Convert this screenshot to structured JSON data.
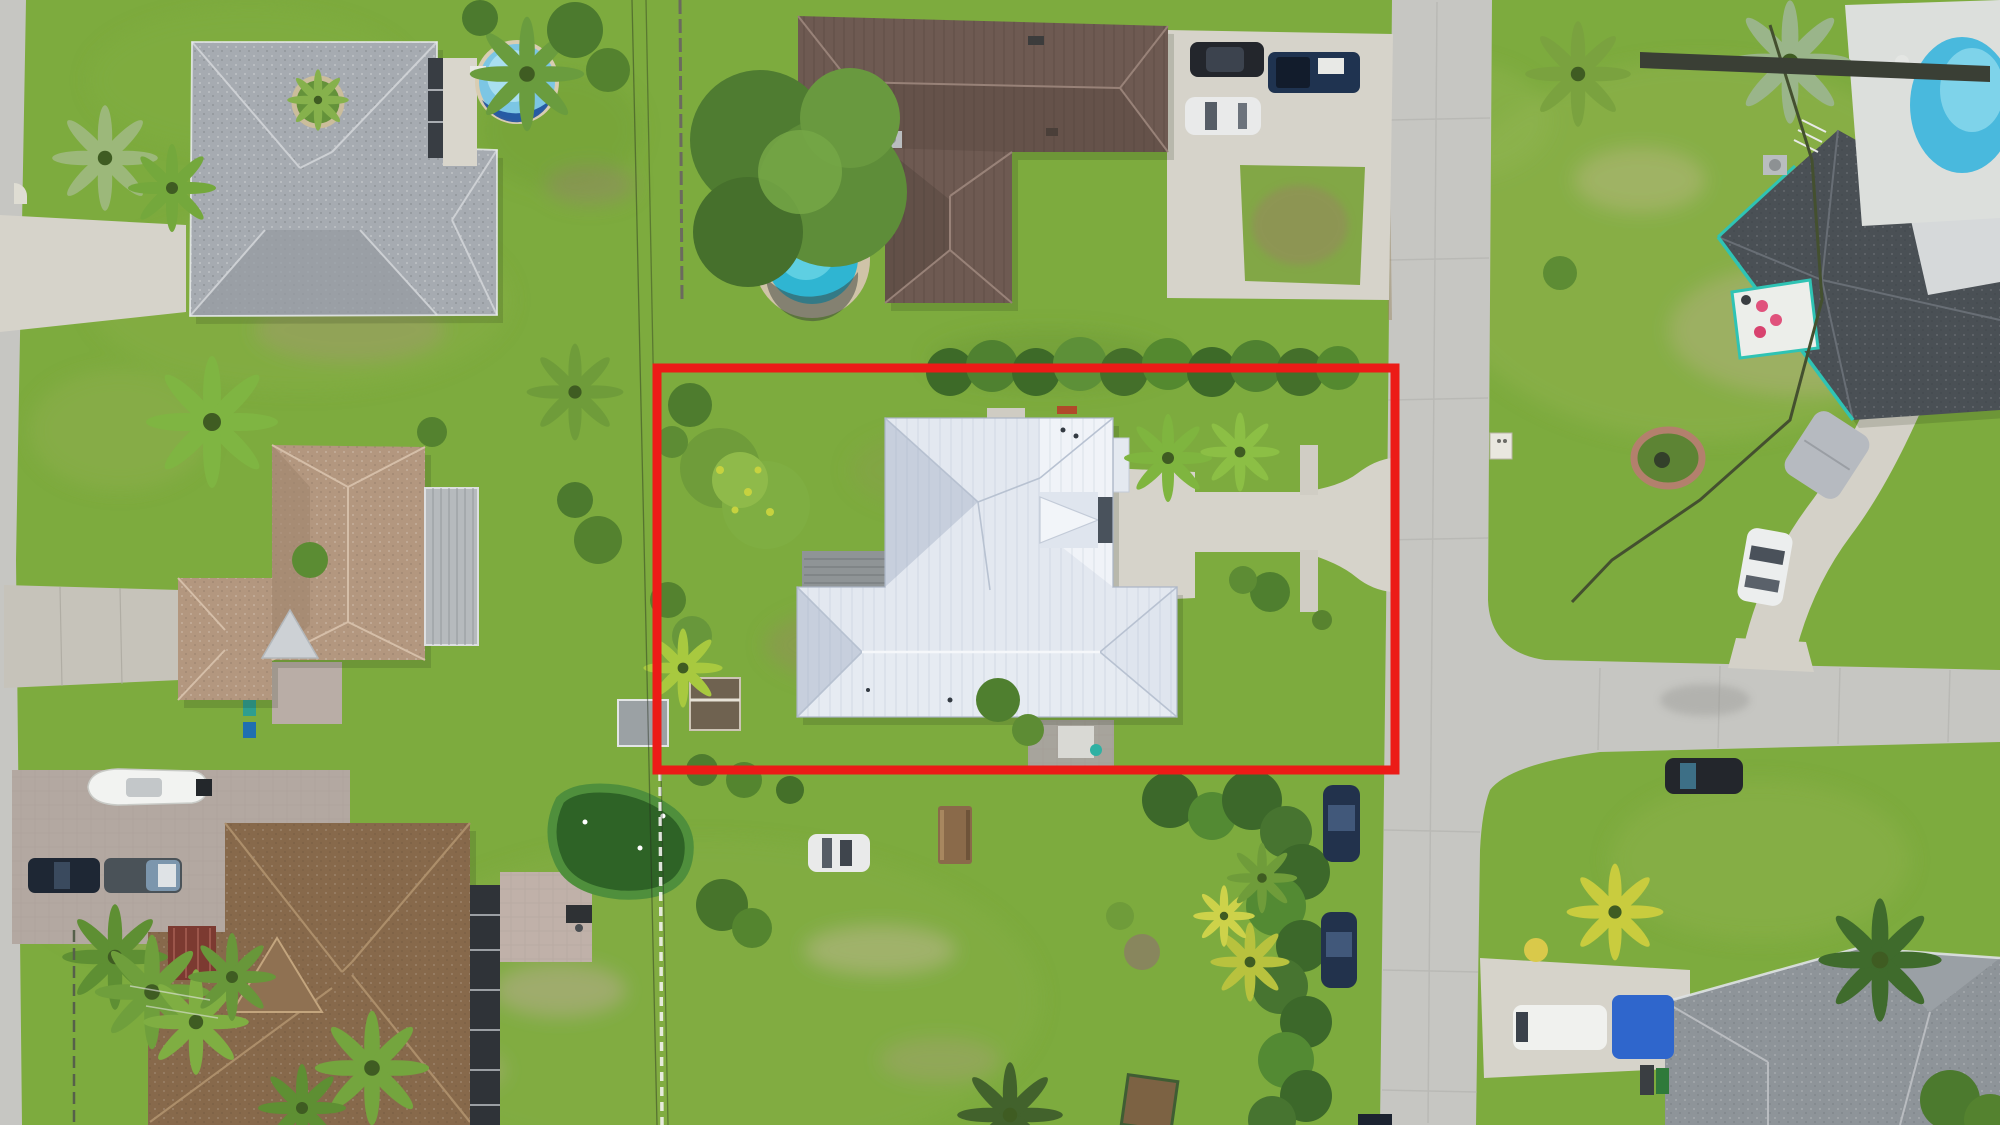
{
  "meta": {
    "title": "Aerial drone photo of suburban neighborhood with outlined property lot",
    "view": "top-down",
    "width_px": 2000,
    "height_px": 1125
  },
  "annotation": {
    "name": "property-boundary",
    "shape": "rectangle",
    "purpose": "highlights the listed lot (white metal-roof house with driveway to street)"
  },
  "colors": {
    "grass": "#7dab3e",
    "grass_light": "#8db34a",
    "road": "#c6c6c2",
    "concrete": "#d6d3ca",
    "concrete_old": "#c6c3ba",
    "paver": "#b3a8a1",
    "boundary": "#ec1b17",
    "roof_subject": "#e3e8f0",
    "roof_subject_shade": "#c7cfdd",
    "roof_brown": "#6e5a52",
    "roof_gray": "#a6abb1",
    "roof_tan": "#b3977f",
    "roof_brown_bl": "#87694b",
    "roof_gray_br": "#8e9499",
    "roof_dark_tr": "#4a5055",
    "teal_trim": "#2fc3b4",
    "pool_round": "#7cc6e4",
    "pool_ring": "#1d4f9c",
    "pool_small": "#2fb5d2",
    "pool_kidney": "#49b9dd",
    "pool_deck": "#dcdfdc",
    "putting_green": "#2e6326",
    "putting_fringe": "#4f8f3c",
    "hedge": "#3f6d28",
    "tree": "#5e8d39",
    "palm": "#7fb542",
    "deck_wood": "#8f9496",
    "lanai": "#2f3338",
    "tarp_blue": "#2f66cc",
    "mulch_red": "#8a4a2e",
    "boat_white": "#f2f3f1",
    "vehicle_dark": "#23262c",
    "vehicle_navy": "#1f3350",
    "vehicle_white": "#e9eaea"
  },
  "objects": [
    {
      "name": "subject-house",
      "desc": "white standing-seam metal hip roof house inside red boundary"
    },
    {
      "name": "subject-driveway",
      "desc": "concrete drive flaring to street on east side"
    },
    {
      "name": "north-south-road",
      "desc": "concrete street along east side of lot"
    },
    {
      "name": "east-branch-road",
      "desc": "side street joining at T-intersection"
    },
    {
      "name": "west-road",
      "desc": "street strip at far left edge"
    },
    {
      "name": "house-top-left",
      "desc": "gray shingle roof home with above-ground pool"
    },
    {
      "name": "house-top-center",
      "desc": "brown metal roof home with small round pool and parking pad"
    },
    {
      "name": "house-top-right",
      "desc": "dark roof home with teal trim, kidney pool, curved driveway"
    },
    {
      "name": "house-mid-left",
      "desc": "tan shingle roof home with metal awning"
    },
    {
      "name": "house-bottom-left",
      "desc": "brown shingle roof home with boat and two pickup trucks"
    },
    {
      "name": "house-bottom-right",
      "desc": "gray roof home with white van and blue tarp"
    },
    {
      "name": "open-lot",
      "desc": "grassy lot south of boundary with parked white car and picnic table"
    },
    {
      "name": "putting-green",
      "desc": "backyard putting green southwest of boundary"
    }
  ]
}
